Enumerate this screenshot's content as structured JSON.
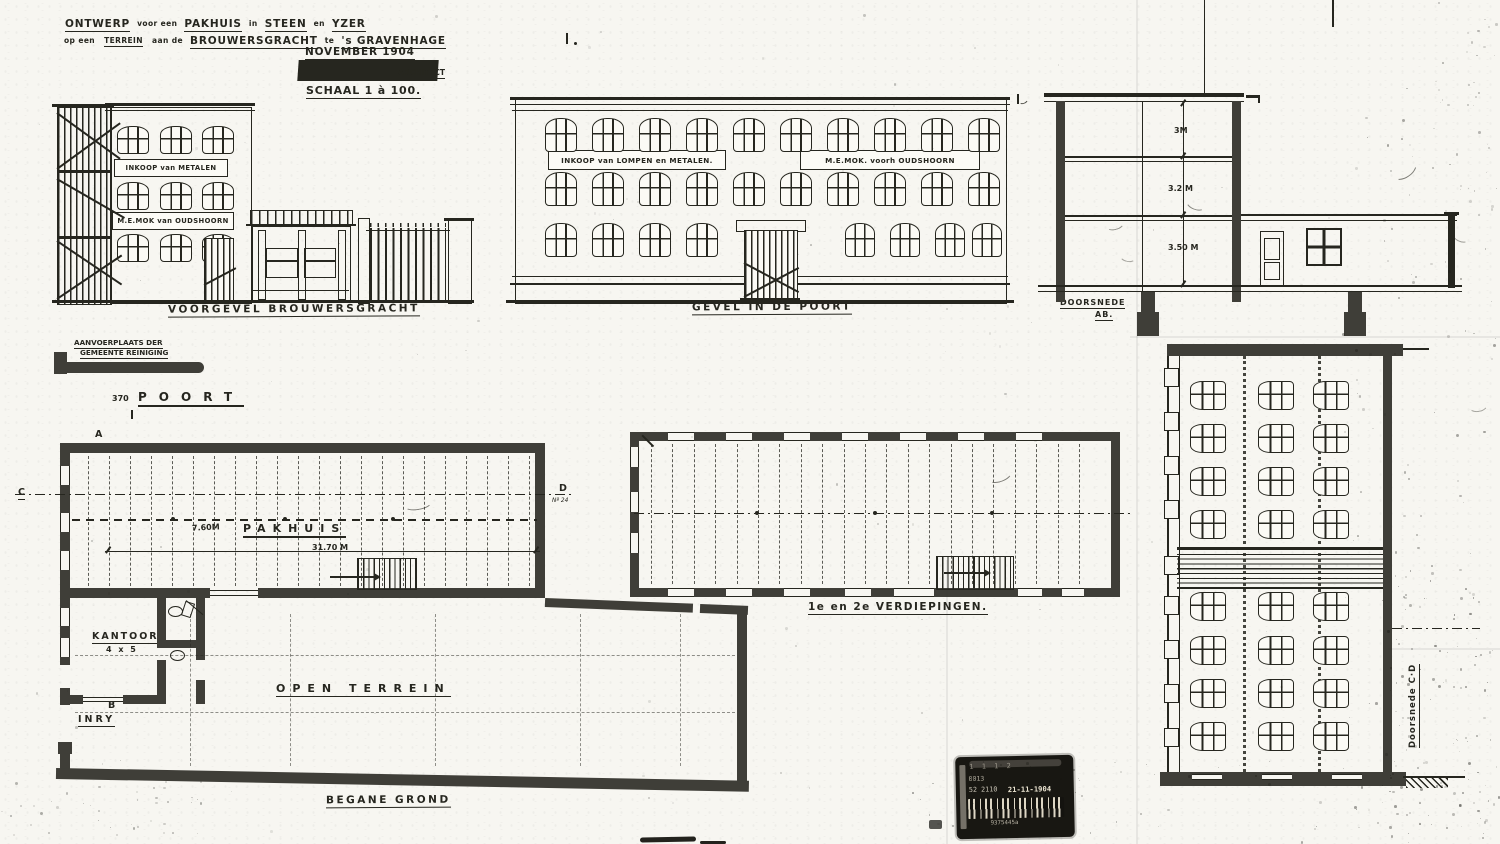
{
  "colors": {
    "ink": "#26261f",
    "wall": "#3f3e38",
    "paper": "#f7f6f1"
  },
  "title_block": {
    "w1": "ONTWERP",
    "j1": "voor een",
    "w2": "PAKHUIS",
    "j2": "in",
    "w3": "STEEN",
    "j3": "en",
    "w4": "YZER",
    "l2j1": "op een",
    "l2w1": "TERREIN",
    "l2j2": "aan de",
    "l2w2": "BROUWERSGRACHT",
    "l2j3": "te",
    "l2w3": "'s GRAVENHAGE",
    "date": "NOVEMBER 1904",
    "architect": "ARCHITECT",
    "scale": "SCHAAL 1 à 100."
  },
  "elevations": {
    "front": {
      "sign_metalen": "INKOOP van METALEN",
      "sign_mok": "M.E.MOK van OUDSHOORN",
      "caption": "VOORGEVEL BROUWERSGRACHT"
    },
    "gate": {
      "sign_lompen": "INKOOP van LOMPEN en METALEN.",
      "sign_mok": "M.E.MOK. voorh OUDSHOORN",
      "caption": "GEVEL IN DE POORT"
    },
    "section_ab": {
      "caption1": "DOORSNEDE",
      "caption2": "AB.",
      "dim_top": "3M",
      "dim_mid": "3.2 M",
      "dim_low": "3.50 M"
    },
    "section_cd": {
      "caption": "Doorsnede C·D"
    }
  },
  "site": {
    "aanvoer1": "AANVOERPLAATS DER",
    "aanvoer2": "GEMEENTE REINIGING",
    "poort_nr": "370",
    "poort": "POORT"
  },
  "plans": {
    "ground": {
      "marker_a": "A",
      "marker_b": "B",
      "marker_c": "C",
      "marker_d": "D",
      "note_d": "Nº 24",
      "width": "7.60M",
      "hall": "PAKHUIS",
      "length": "31.70 M",
      "office": "KANTOOR",
      "office_size": "4 x 5",
      "wc": "WC",
      "entry": "INRY",
      "open": "OPEN TERREIN",
      "caption": "BEGANE GROND"
    },
    "upper": {
      "caption": "1e en 2e VERDIEPINGEN."
    }
  },
  "stamp": {
    "row_top": "1 1 1   2",
    "row_code": "0013",
    "row_num": "52 2110",
    "date": "21-11-1904",
    "barcode": "9375445a"
  }
}
